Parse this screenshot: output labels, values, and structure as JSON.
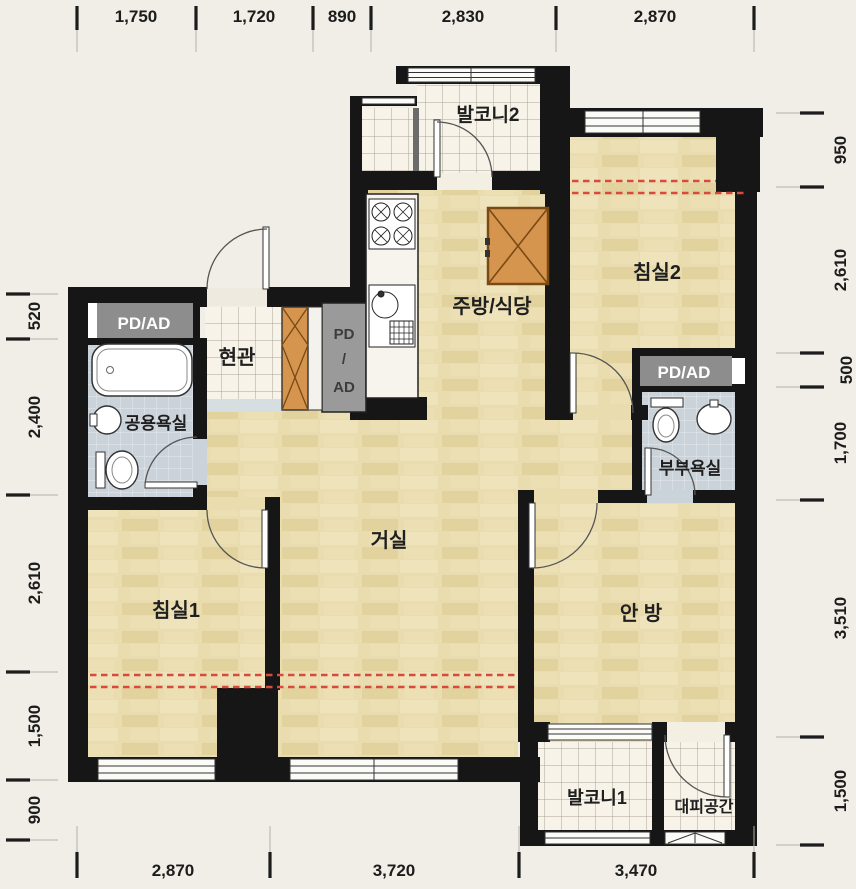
{
  "title": "apartment-floor-plan",
  "colors": {
    "background": "#f1eee7",
    "wall": "#161616",
    "wood_floor": "#e9dcae",
    "balcony_tile": "#f7f3e8",
    "bath_tile": "#cbd3da",
    "shaft_gray": "#8d8d8d",
    "furniture_orange": "#d6954e",
    "red_dashed": "#d84b3c"
  },
  "rooms": {
    "balcony2": "발코니2",
    "bedroom2": "침실2",
    "kitchen_dining": "주방/식당",
    "entrance": "현관",
    "common_bathroom": "공용욕실",
    "master_bathroom": "부부욕실",
    "living_room": "거실",
    "bedroom1": "침실1",
    "master_bedroom": "안 방",
    "balcony1": "발코니1",
    "refuge": "대피공간"
  },
  "shafts": {
    "left": "PD/AD",
    "middle": [
      "PD",
      "/",
      "AD"
    ],
    "right": "PD/AD"
  },
  "dimensions": {
    "top": [
      "1,750",
      "1,720",
      "890",
      "2,830",
      "2,870"
    ],
    "right": [
      "950",
      "2,610",
      "500",
      "1,700",
      "3,510",
      "1,500"
    ],
    "bottom": [
      "2,870",
      "3,720",
      "3,470"
    ],
    "left": [
      "520",
      "2,400",
      "2,610",
      "1,500",
      "900"
    ]
  }
}
